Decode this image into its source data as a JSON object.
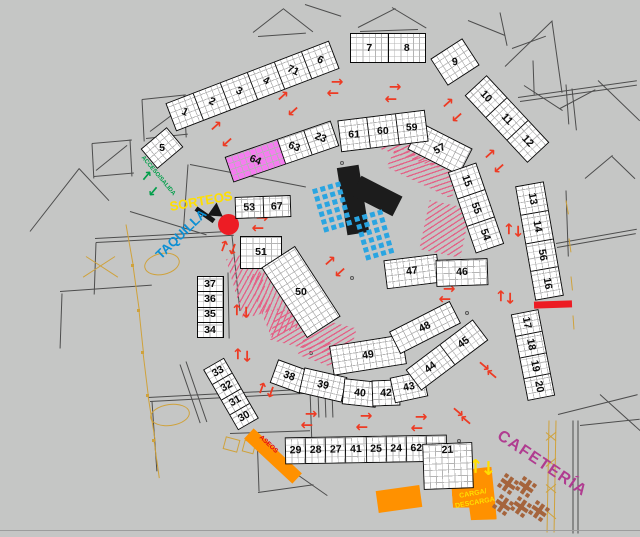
{
  "plan_title": "recinto ferial - plano de puestos",
  "colors": {
    "background": "#c5c6c5",
    "stall_fill": "#ffffff",
    "stall_border": "#0a0a0a",
    "grid_line": "#b4b4b4",
    "pink_stall": "#f57df0",
    "red_arrow": "#ed3b24",
    "red_marker": "#ed1c24",
    "orange_zone": "#ff9100",
    "yellow_text": "#ffdf00",
    "green_access": "#009e49",
    "blue_taquilla": "#0b8fd4",
    "magenta_cafeteria": "#b03c90",
    "aseos_red": "#e30613",
    "chair_blue": "#2aa5e1",
    "hatch_pink": "#e36287",
    "wall_gray": "#4d4d4d",
    "furniture_tan": "#cfa23c",
    "stage_black": "#1c1c1c"
  },
  "labels": [
    {
      "t": "SORTEOS",
      "x": 201,
      "y": 201,
      "r": -10,
      "s": 13,
      "c": "#ffdf00",
      "n": "sorteos-label"
    },
    {
      "t": "TAQUILLA",
      "x": 181,
      "y": 234,
      "r": -44,
      "s": 13,
      "c": "#0b8fd4",
      "n": "taquilla-label"
    },
    {
      "t": "ACCESO/SALIDA",
      "x": 158,
      "y": 176,
      "r": 50,
      "s": 6,
      "c": "#009e49",
      "n": "acceso-salida-label"
    },
    {
      "t": "CAFETERÍA",
      "x": 542,
      "y": 464,
      "r": 34,
      "s": 16,
      "c": "#b03c90",
      "sp": 1.5,
      "n": "cafeteria-label"
    },
    {
      "t": "ASEOS",
      "x": 268,
      "y": 445,
      "r": 43,
      "s": 6.5,
      "c": "#e30613",
      "n": "aseos-label"
    },
    {
      "t": "CARGA/",
      "x": 473,
      "y": 494,
      "r": -10,
      "s": 7,
      "c": "#ffdf00",
      "n": "carga-label"
    },
    {
      "t": "DESCARGA",
      "x": 475,
      "y": 503,
      "r": -10,
      "s": 7,
      "c": "#ffdf00",
      "n": "descarga-label"
    }
  ],
  "stalls": [
    {
      "x": 252,
      "y": 86,
      "w": 175,
      "h": 30,
      "rot": -21,
      "lr": 45,
      "cells": [
        "1",
        "2",
        "3",
        "4",
        "71",
        "6"
      ]
    },
    {
      "x": 162,
      "y": 148,
      "w": 34,
      "h": 26,
      "rot": -40,
      "lr": 40,
      "label": "5"
    },
    {
      "x": 282,
      "y": 151,
      "w": 112,
      "h": 27,
      "rot": -19,
      "lr": 40,
      "cells": [
        {
          "t": "64",
          "w": 50,
          "f": "#f57df0"
        },
        {
          "t": "63",
          "w": 25
        },
        {
          "t": "23",
          "w": 25
        }
      ]
    },
    {
      "x": 263,
      "y": 207,
      "w": 56,
      "h": 22,
      "rot": -2,
      "cells": [
        "53",
        "67"
      ]
    },
    {
      "x": 261,
      "y": 252,
      "w": 42,
      "h": 33,
      "rot": 0,
      "label": "51"
    },
    {
      "x": 301,
      "y": 292,
      "w": 40,
      "h": 84,
      "rot": -33,
      "lr": 33,
      "label": "50"
    },
    {
      "x": 210,
      "y": 307,
      "w": 27,
      "h": 62,
      "rot": 0,
      "vert": true,
      "cells": [
        "37",
        "36",
        "35",
        "34"
      ]
    },
    {
      "x": 231,
      "y": 394,
      "w": 24,
      "h": 70,
      "rot": -30,
      "vert": true,
      "cells": [
        "33",
        "32",
        "31",
        "30"
      ]
    },
    {
      "x": 366,
      "y": 449,
      "w": 162,
      "h": 27,
      "rot": -1,
      "cells": [
        "29",
        "28",
        "27",
        "41",
        "25",
        "24",
        "62",
        "22"
      ]
    },
    {
      "x": 448,
      "y": 466,
      "w": 50,
      "h": 46,
      "rot": -2,
      "label": "21",
      "lp": "t"
    },
    {
      "x": 289,
      "y": 376,
      "w": 32,
      "h": 25,
      "rot": 20,
      "label": "38"
    },
    {
      "x": 323,
      "y": 385,
      "w": 44,
      "h": 26,
      "rot": 13,
      "label": "39"
    },
    {
      "x": 360,
      "y": 393,
      "w": 34,
      "h": 26,
      "rot": 6,
      "label": "40"
    },
    {
      "x": 386,
      "y": 393,
      "w": 28,
      "h": 26,
      "rot": -2,
      "label": "42"
    },
    {
      "x": 409,
      "y": 387,
      "w": 34,
      "h": 26,
      "rot": -12,
      "label": "43"
    },
    {
      "x": 368,
      "y": 355,
      "w": 74,
      "h": 30,
      "rot": -9,
      "label": "49"
    },
    {
      "x": 447,
      "y": 355,
      "w": 84,
      "h": 26,
      "rot": -37,
      "cells": [
        "44",
        "45"
      ]
    },
    {
      "x": 425,
      "y": 327,
      "w": 68,
      "h": 25,
      "rot": -27,
      "label": "48"
    },
    {
      "x": 412,
      "y": 271,
      "w": 54,
      "h": 29,
      "rot": -7,
      "label": "47"
    },
    {
      "x": 462,
      "y": 272,
      "w": 52,
      "h": 27,
      "rot": -2,
      "label": "46"
    },
    {
      "x": 440,
      "y": 149,
      "w": 58,
      "h": 30,
      "rot": 27,
      "lr": -55,
      "label": "57"
    },
    {
      "x": 476,
      "y": 208,
      "w": 30,
      "h": 86,
      "rot": -19,
      "lr": 90,
      "vert": true,
      "cells": [
        "15",
        "55",
        "54"
      ]
    },
    {
      "x": 539,
      "y": 241,
      "w": 29,
      "h": 116,
      "rot": -10,
      "lr": 90,
      "vert": true,
      "cells": [
        "13",
        "14",
        "56",
        "16"
      ]
    },
    {
      "x": 533,
      "y": 355,
      "w": 28,
      "h": 88,
      "rot": -11,
      "lr": 90,
      "vert": true,
      "cells": [
        "17",
        "18",
        "19",
        "20"
      ]
    },
    {
      "x": 507,
      "y": 119,
      "w": 30,
      "h": 92,
      "rot": -43,
      "lr": 90,
      "vert": true,
      "cells": [
        "10",
        "11",
        "12"
      ]
    },
    {
      "x": 455,
      "y": 62,
      "w": 38,
      "h": 32,
      "rot": -33,
      "lr": 25,
      "label": "9"
    },
    {
      "x": 388,
      "y": 48,
      "w": 76,
      "h": 30,
      "rot": 0,
      "cells": [
        "7",
        "8"
      ]
    },
    {
      "x": 383,
      "y": 131,
      "w": 88,
      "h": 32,
      "rot": -7,
      "lr": 7,
      "cells": [
        "61",
        "60",
        "59"
      ]
    }
  ],
  "arrows": {
    "red": [
      [
        216,
        126,
        -42
      ],
      [
        227,
        142,
        138
      ],
      [
        283,
        96,
        -42
      ],
      [
        293,
        111,
        138
      ],
      [
        337,
        82,
        0
      ],
      [
        333,
        93,
        180
      ],
      [
        395,
        87,
        0
      ],
      [
        391,
        99,
        180
      ],
      [
        448,
        103,
        -42
      ],
      [
        457,
        117,
        138
      ],
      [
        490,
        154,
        -42
      ],
      [
        499,
        168,
        138
      ],
      [
        509,
        229,
        -90
      ],
      [
        518,
        231,
        90
      ],
      [
        501,
        296,
        -90
      ],
      [
        510,
        298,
        90
      ],
      [
        449,
        289,
        0
      ],
      [
        445,
        299,
        180
      ],
      [
        330,
        261,
        -42
      ],
      [
        340,
        272,
        138
      ],
      [
        262,
        218,
        0
      ],
      [
        258,
        228,
        180
      ],
      [
        224,
        246,
        -70
      ],
      [
        233,
        249,
        110
      ],
      [
        237,
        310,
        -90
      ],
      [
        246,
        312,
        90
      ],
      [
        238,
        354,
        -90
      ],
      [
        247,
        356,
        90
      ],
      [
        262,
        388,
        -70
      ],
      [
        271,
        392,
        110
      ],
      [
        311,
        414,
        0
      ],
      [
        307,
        425,
        180
      ],
      [
        366,
        416,
        0
      ],
      [
        362,
        427,
        180
      ],
      [
        421,
        417,
        0
      ],
      [
        417,
        428,
        180
      ],
      [
        458,
        412,
        40
      ],
      [
        466,
        420,
        -140
      ],
      [
        484,
        366,
        40
      ],
      [
        492,
        374,
        -140
      ]
    ],
    "green": [
      [
        147,
        176,
        -50
      ],
      [
        153,
        191,
        130
      ]
    ],
    "yellow": [
      [
        476,
        466,
        -90
      ],
      [
        488,
        468,
        90
      ]
    ]
  },
  "stage_bars": [
    [
      353,
      200,
      22,
      68,
      -9
    ],
    [
      377,
      196,
      46,
      22,
      27
    ]
  ],
  "red_circle": {
    "x": 228,
    "y": 224,
    "d": 21
  },
  "red_bar": {
    "x": 553,
    "y": 304,
    "w": 38,
    "h": 7,
    "r": -2
  },
  "black_arrow": {
    "x": 196,
    "y": 206,
    "len": 22,
    "r": 35
  },
  "orange_zones": [
    {
      "n": "aseos-bar",
      "x": 240,
      "y": 449,
      "w": 66,
      "h": 14,
      "r": 43
    },
    {
      "n": "loading-small",
      "x": 377,
      "y": 488,
      "w": 44,
      "h": 22,
      "r": -8
    },
    {
      "n": "carga-descarga-zone",
      "x": 452,
      "y": 468,
      "w": 43,
      "h": 53,
      "r": -4,
      "clip": "polygon(0% 4%, 96% 0%, 100% 100%, 40% 98%, 38% 74%, 0% 72%)"
    }
  ],
  "hatches": [
    [
      372,
      136,
      76,
      22,
      18
    ],
    [
      388,
      160,
      72,
      24,
      26
    ],
    [
      424,
      204,
      42,
      50,
      12
    ],
    [
      234,
      254,
      30,
      62,
      -16
    ],
    [
      258,
      268,
      34,
      66,
      -22
    ],
    [
      272,
      318,
      82,
      32,
      14
    ],
    [
      300,
      342,
      50,
      22,
      20
    ]
  ],
  "chair_grids": [
    {
      "x": 318,
      "y": 184,
      "cols": 4,
      "rows": 6,
      "pitch": 8,
      "cell": 4.5,
      "rot": -16
    },
    {
      "x": 360,
      "y": 212,
      "cols": 4,
      "rows": 6,
      "pitch": 8,
      "cell": 4.5,
      "rot": -16
    }
  ],
  "cafe_tables": [
    [
      508,
      484
    ],
    [
      526,
      487
    ],
    [
      503,
      505
    ],
    [
      521,
      507
    ],
    [
      539,
      511
    ]
  ],
  "ellipses": [
    [
      144,
      253,
      36,
      22,
      -12
    ],
    [
      150,
      404,
      40,
      22,
      -8
    ]
  ],
  "tan_rects": [
    [
      224,
      438,
      15,
      13,
      15
    ],
    [
      243,
      441,
      12,
      12,
      15
    ]
  ],
  "tan_posts": [
    [
      131,
      264
    ],
    [
      137,
      309
    ],
    [
      141,
      351
    ],
    [
      146,
      394
    ],
    [
      152,
      439
    ]
  ],
  "dots": [
    [
      340,
      161
    ],
    [
      469,
      91
    ],
    [
      350,
      276
    ],
    [
      465,
      311
    ],
    [
      251,
      203
    ],
    [
      309,
      351
    ],
    [
      457,
      439
    ],
    [
      446,
      260
    ]
  ],
  "walls": [
    [
      253,
      32,
      38,
      -38
    ],
    [
      283,
      8,
      38,
      38
    ],
    [
      258,
      36,
      48,
      -4
    ],
    [
      358,
      27,
      42,
      -27
    ],
    [
      392,
      7,
      40,
      31
    ],
    [
      360,
      31,
      58,
      -2
    ],
    [
      305,
      4,
      38,
      18
    ],
    [
      505,
      66,
      66,
      -44
    ],
    [
      552,
      21,
      72,
      82
    ],
    [
      518,
      97,
      120,
      -8
    ],
    [
      520,
      101,
      118,
      -8
    ],
    [
      533,
      60,
      34,
      88
    ],
    [
      560,
      108,
      40,
      -28
    ],
    [
      566,
      84,
      40,
      86
    ],
    [
      598,
      80,
      58,
      44
    ],
    [
      468,
      20,
      40,
      22
    ],
    [
      500,
      12,
      34,
      78
    ],
    [
      512,
      48,
      36,
      -20
    ],
    [
      524,
      85,
      46,
      33
    ],
    [
      572,
      88,
      42,
      84
    ],
    [
      585,
      178,
      36,
      -40
    ],
    [
      612,
      156,
      32,
      44
    ],
    [
      566,
      190,
      66,
      88
    ],
    [
      556,
      243,
      82,
      -10
    ],
    [
      557,
      247,
      80,
      -10
    ],
    [
      558,
      414,
      82,
      -14
    ],
    [
      600,
      394,
      54,
      42
    ],
    [
      573,
      420,
      113,
      90
    ],
    [
      578,
      420,
      113,
      90
    ],
    [
      580,
      425,
      60,
      -6
    ],
    [
      549,
      420,
      112,
      91,
      "t"
    ],
    [
      556,
      420,
      112,
      91,
      "t"
    ],
    [
      546,
      432,
      13,
      40,
      "t"
    ],
    [
      546,
      440,
      13,
      -40,
      "t"
    ],
    [
      546,
      458,
      13,
      40,
      "t"
    ],
    [
      546,
      466,
      13,
      -40,
      "t"
    ],
    [
      546,
      484,
      13,
      40,
      "t"
    ],
    [
      546,
      492,
      13,
      -40,
      "t"
    ],
    [
      546,
      510,
      13,
      40,
      "t"
    ],
    [
      148,
      397,
      160,
      -3
    ],
    [
      150,
      401,
      158,
      -3
    ],
    [
      152,
      401,
      70,
      86
    ],
    [
      230,
      433,
      80,
      -2
    ],
    [
      257,
      433,
      58,
      88
    ],
    [
      310,
      389,
      60,
      88
    ],
    [
      318,
      391,
      26,
      88
    ],
    [
      325,
      391,
      26,
      88
    ],
    [
      332,
      391,
      26,
      88
    ],
    [
      258,
      492,
      56,
      -8
    ],
    [
      190,
      164,
      118,
      11
    ],
    [
      188,
      164,
      66,
      94
    ],
    [
      130,
      211,
      80,
      17
    ],
    [
      95,
      238,
      140,
      -3
    ],
    [
      96,
      242,
      138,
      -3
    ],
    [
      96,
      242,
      52,
      92
    ],
    [
      232,
      235,
      76,
      84
    ],
    [
      60,
      291,
      92,
      -4
    ],
    [
      62,
      293,
      55,
      92
    ],
    [
      142,
      99,
      44,
      -6
    ],
    [
      142,
      99,
      42,
      87
    ],
    [
      146,
      138,
      42,
      -6
    ],
    [
      184,
      95,
      42,
      87
    ],
    [
      150,
      131,
      42,
      -37
    ],
    [
      92,
      143,
      40,
      -5
    ],
    [
      92,
      143,
      35,
      87
    ],
    [
      94,
      176,
      40,
      -5
    ],
    [
      130,
      139,
      37,
      87
    ],
    [
      96,
      170,
      40,
      -39
    ],
    [
      30,
      231,
      80,
      -52
    ],
    [
      79,
      168,
      44,
      47
    ],
    [
      228,
      272,
      66,
      89
    ],
    [
      186,
      361,
      64,
      71
    ],
    [
      180,
      364,
      62,
      71
    ],
    [
      270,
      455,
      70,
      35
    ],
    [
      566,
      200,
      14,
      80,
      "t"
    ],
    [
      569,
      238,
      14,
      82,
      "t"
    ],
    [
      571,
      276,
      14,
      84,
      "t"
    ],
    [
      573,
      315,
      14,
      86,
      "t"
    ],
    [
      126,
      224,
      42,
      80,
      "t"
    ],
    [
      133,
      265,
      46,
      82,
      "t"
    ],
    [
      139,
      310,
      42,
      84,
      "t"
    ],
    [
      143,
      352,
      44,
      83,
      "t"
    ],
    [
      148,
      395,
      46,
      81,
      "t"
    ],
    [
      154,
      440,
      38,
      82,
      "t"
    ],
    [
      86,
      256,
      38,
      33,
      "t"
    ],
    [
      115,
      256,
      38,
      147,
      "t"
    ],
    [
      0,
      530,
      640,
      0,
      "#9d9d9d"
    ]
  ]
}
